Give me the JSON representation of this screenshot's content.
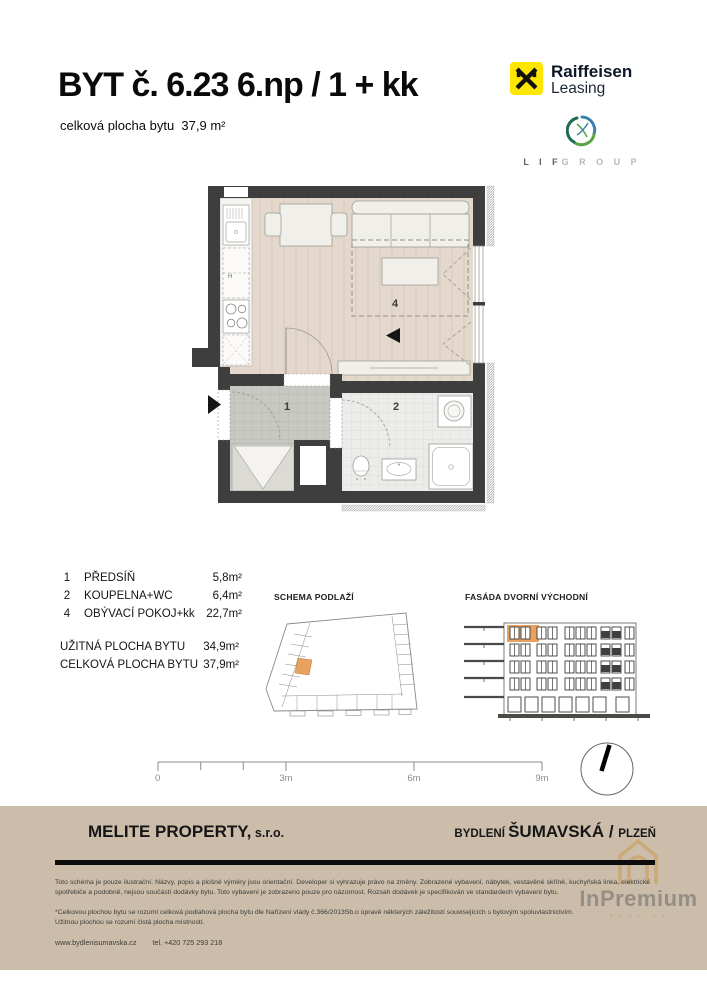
{
  "header": {
    "title": "BYT č. 6.23 6.np / 1 + kk",
    "area_label": "celková plocha bytu",
    "area_value": "37,9 m²"
  },
  "brands": {
    "raiffeisen": {
      "line1": "Raiffeisen",
      "line2": "Leasing",
      "box_color": "#ffe600"
    },
    "lif": {
      "part1": "L I F",
      "part2": "G R O U P"
    }
  },
  "plan": {
    "room_numbers": {
      "hall": "1",
      "bath": "2",
      "living": "4"
    },
    "kitchen_label": "H"
  },
  "legend": {
    "rooms": [
      {
        "num": "1",
        "name": "PŘEDSÍŇ",
        "area": "5,8m²"
      },
      {
        "num": "2",
        "name": "KOUPELNA+WC",
        "area": "6,4m²"
      },
      {
        "num": "4",
        "name": "OBÝVACÍ POKOJ+kk",
        "area": "22,7m²"
      }
    ],
    "totals": [
      {
        "label": "UŽITNÁ PLOCHA BYTU",
        "area": "34,9m²"
      },
      {
        "label": "CELKOVÁ PLOCHA BYTU",
        "area": "37,9m²"
      }
    ]
  },
  "sections": {
    "schema": "SCHEMA PODLAŽÍ",
    "fasada": "FASÁDA DVORNÍ VÝCHODNÍ"
  },
  "scalebar": {
    "labels": [
      "0",
      "3m",
      "6m",
      "9m"
    ]
  },
  "footer": {
    "company": "MELITE PROPERTY,",
    "company_suffix": " s.r.o.",
    "project": {
      "prefix": "BYDLENÍ ",
      "name": "ŠUMAVSKÁ",
      "sep": " / ",
      "city": "PLZEŇ"
    },
    "disclaimer": "Toto schéma je pouze ilustrační. Názvy, popis a plošné výměry jsou orientační. Developer si vyhrazuje právo na změny. Zobrazené vybavení, nábytek, vestavěné skříně, kuchyňská linka, elektrické spotřebiče a podobně, nejsou součástí dodávky bytu. Toto vybavení je zobrazeno pouze pro názornost. Rozsah dodávek je specifikován ve standardech vybavení bytu.",
    "note1": "*Celkovou plochou bytu se rozumí celková podlahová plocha bytu dle Nařízení vlády č.366/2013Sb.o úpravě některých záležitostí souvisejících s bytovým spoluvlastnictvím.",
    "note2": "Užitnou plochou se rozumí čistá plocha místností.",
    "website": "www.bydlenisumavska.cz",
    "phone": "tel.  +420 725 293 218",
    "watermark": {
      "text": "InPremium",
      "sub": "R E A L I T Y"
    },
    "band_color": "#cbbdaa"
  },
  "colors": {
    "highlight_orange": "#e8a25f",
    "wall": "#3e3e3e",
    "floor_living": "#e3d8cb",
    "floor_hall": "#c8c7c2",
    "floor_bath": "#ececea",
    "raiffeisen_yellow": "#ffe600"
  }
}
